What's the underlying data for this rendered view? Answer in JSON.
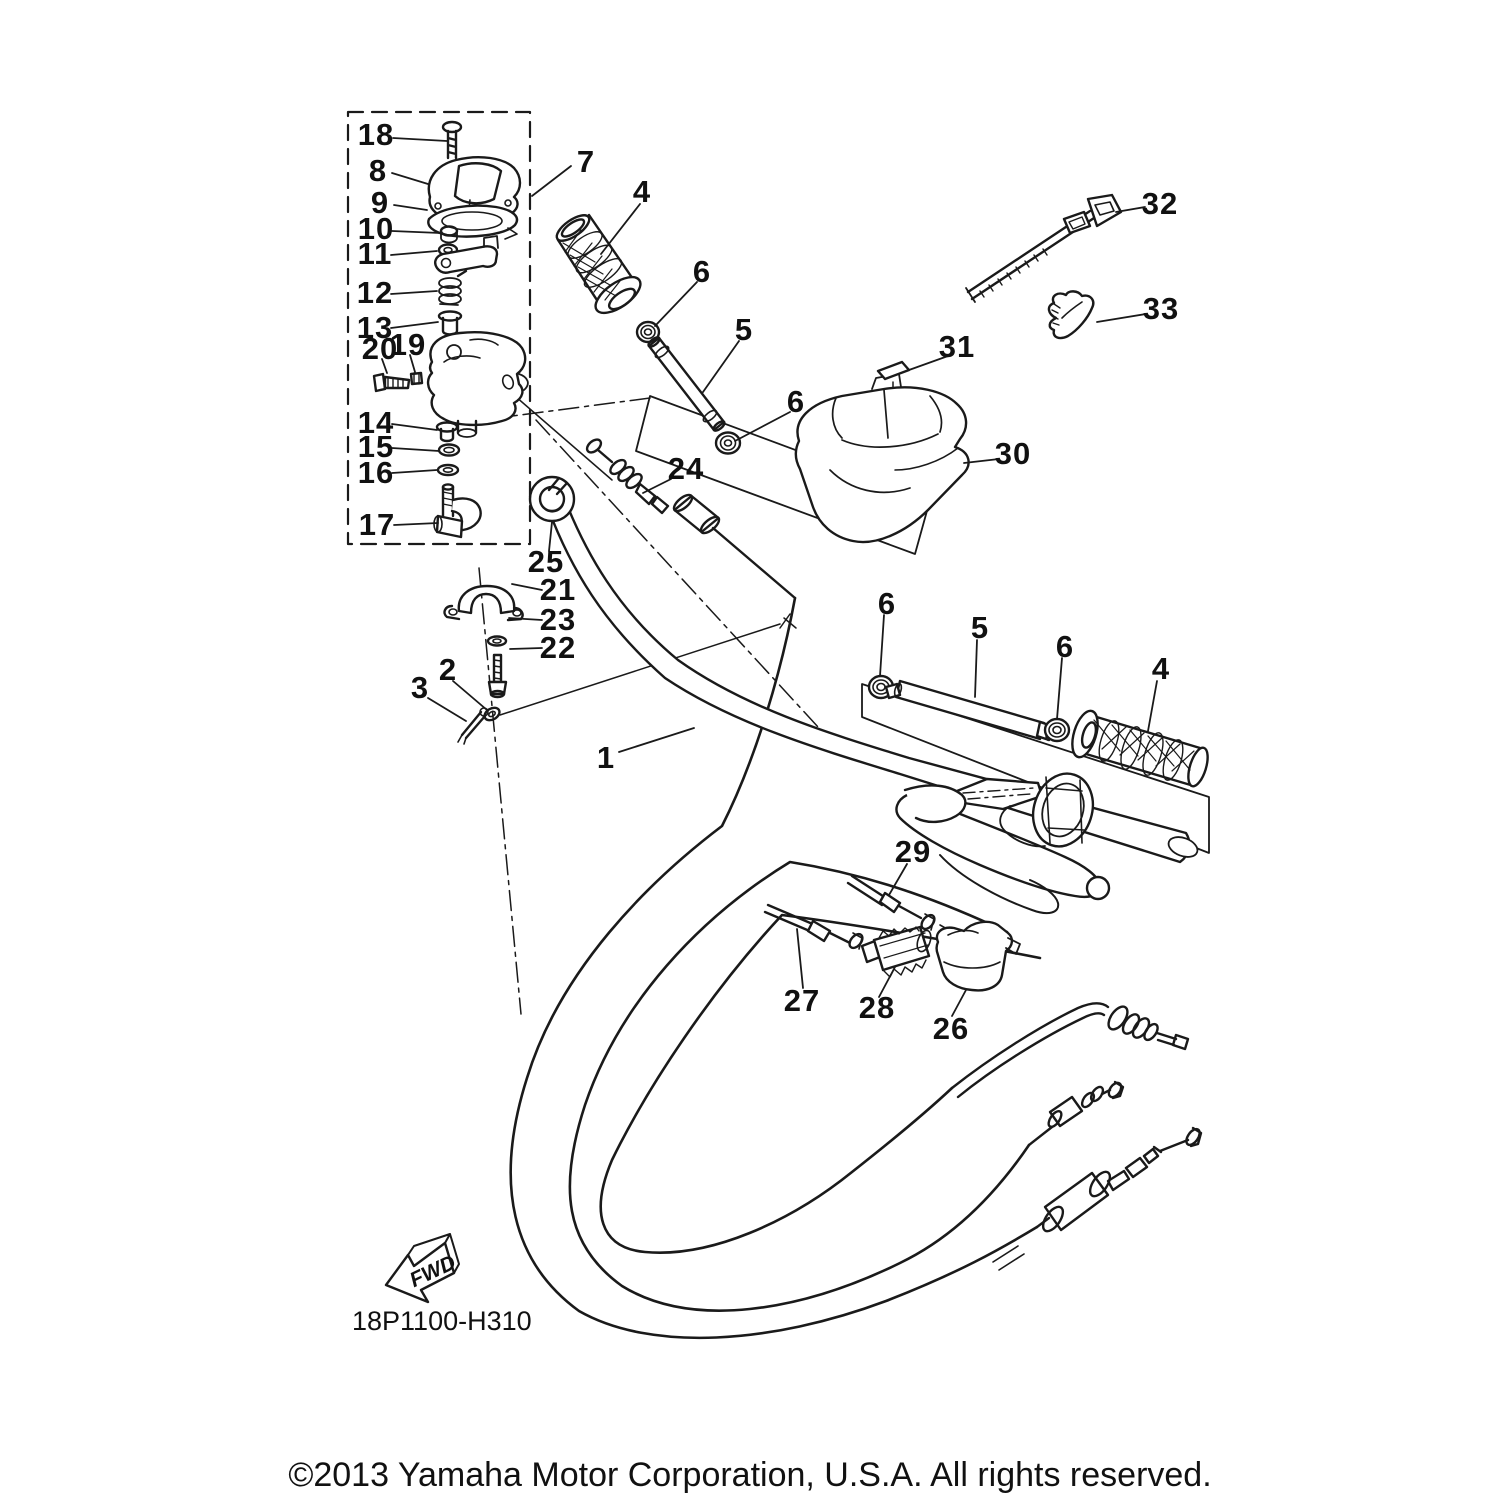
{
  "diagram": {
    "code": "18P1100-H310",
    "fwd_label": "FWD",
    "copyright": "©2013 Yamaha Motor Corporation, U.S.A. All rights reserved.",
    "line_color": "#1a1a1a",
    "background_color": "#ffffff",
    "callouts": [
      {
        "label": "18",
        "x": 376,
        "y": 135,
        "leader": [
          393,
          138,
          447,
          141
        ]
      },
      {
        "label": "8",
        "x": 378,
        "y": 171,
        "leader": [
          392,
          173,
          428,
          184
        ]
      },
      {
        "label": "9",
        "x": 380,
        "y": 203,
        "leader": [
          394,
          205,
          427,
          210
        ]
      },
      {
        "label": "10",
        "x": 376,
        "y": 229,
        "leader": [
          392,
          231,
          440,
          233
        ]
      },
      {
        "label": "11",
        "x": 375,
        "y": 254,
        "leader": [
          391,
          255,
          437,
          251
        ]
      },
      {
        "label": "12",
        "x": 375,
        "y": 293,
        "leader": [
          391,
          294,
          437,
          291
        ]
      },
      {
        "label": "13",
        "x": 375,
        "y": 328,
        "leader": [
          391,
          328,
          438,
          322
        ]
      },
      {
        "label": "20",
        "x": 380,
        "y": 349,
        "leader": [
          382,
          359,
          387,
          373
        ]
      },
      {
        "label": "19",
        "x": 408,
        "y": 345,
        "leader": [
          410,
          355,
          415,
          372
        ]
      },
      {
        "label": "14",
        "x": 376,
        "y": 423,
        "leader": [
          392,
          424,
          437,
          430
        ]
      },
      {
        "label": "15",
        "x": 376,
        "y": 447,
        "leader": [
          392,
          448,
          439,
          451
        ]
      },
      {
        "label": "16",
        "x": 376,
        "y": 473,
        "leader": [
          392,
          473,
          437,
          470
        ]
      },
      {
        "label": "17",
        "x": 377,
        "y": 525,
        "leader": [
          394,
          525,
          438,
          523
        ]
      },
      {
        "label": "7",
        "x": 586,
        "y": 162,
        "leader": [
          571,
          166,
          532,
          196
        ]
      },
      {
        "label": "4",
        "x": 642,
        "y": 192,
        "leader": [
          640,
          204,
          601,
          254
        ]
      },
      {
        "label": "6",
        "x": 702,
        "y": 272,
        "leader": [
          697,
          282,
          655,
          326
        ]
      },
      {
        "label": "5",
        "x": 744,
        "y": 330,
        "leader": [
          739,
          341,
          703,
          392
        ]
      },
      {
        "label": "6",
        "x": 796,
        "y": 402,
        "leader": [
          790,
          412,
          735,
          441
        ]
      },
      {
        "label": "24",
        "x": 686,
        "y": 469,
        "leader": [
          671,
          479,
          643,
          493
        ]
      },
      {
        "label": "25",
        "x": 546,
        "y": 562,
        "leader": [
          549,
          551,
          552,
          522
        ]
      },
      {
        "label": "21",
        "x": 558,
        "y": 590,
        "leader": [
          542,
          590,
          512,
          584
        ]
      },
      {
        "label": "23",
        "x": 558,
        "y": 620,
        "leader": [
          542,
          620,
          509,
          618
        ]
      },
      {
        "label": "22",
        "x": 558,
        "y": 648,
        "leader": [
          542,
          648,
          510,
          649
        ]
      },
      {
        "label": "2",
        "x": 448,
        "y": 670,
        "leader": [
          453,
          681,
          487,
          710
        ]
      },
      {
        "label": "3",
        "x": 420,
        "y": 688,
        "leader": [
          428,
          698,
          466,
          721
        ]
      },
      {
        "label": "1",
        "x": 606,
        "y": 758,
        "leader": [
          619,
          752,
          694,
          728
        ]
      },
      {
        "label": "32",
        "x": 1160,
        "y": 204,
        "leader": [
          1145,
          207,
          1116,
          212
        ]
      },
      {
        "label": "33",
        "x": 1161,
        "y": 309,
        "leader": [
          1146,
          314,
          1097,
          322
        ]
      },
      {
        "label": "31",
        "x": 957,
        "y": 347,
        "leader": [
          948,
          356,
          909,
          370
        ]
      },
      {
        "label": "30",
        "x": 1013,
        "y": 454,
        "leader": [
          999,
          459,
          964,
          463
        ]
      },
      {
        "label": "6",
        "x": 887,
        "y": 604,
        "leader": [
          884,
          615,
          880,
          676
        ]
      },
      {
        "label": "5",
        "x": 980,
        "y": 628,
        "leader": [
          977,
          640,
          975,
          697
        ]
      },
      {
        "label": "6",
        "x": 1065,
        "y": 647,
        "leader": [
          1062,
          658,
          1057,
          719
        ]
      },
      {
        "label": "4",
        "x": 1161,
        "y": 669,
        "leader": [
          1157,
          681,
          1148,
          731
        ]
      },
      {
        "label": "29",
        "x": 913,
        "y": 852,
        "leader": [
          907,
          864,
          889,
          895
        ]
      },
      {
        "label": "27",
        "x": 802,
        "y": 1001,
        "leader": [
          803,
          988,
          797,
          929
        ]
      },
      {
        "label": "28",
        "x": 877,
        "y": 1008,
        "leader": [
          879,
          997,
          895,
          967
        ]
      },
      {
        "label": "26",
        "x": 951,
        "y": 1029,
        "leader": [
          952,
          1016,
          966,
          990
        ]
      }
    ]
  }
}
